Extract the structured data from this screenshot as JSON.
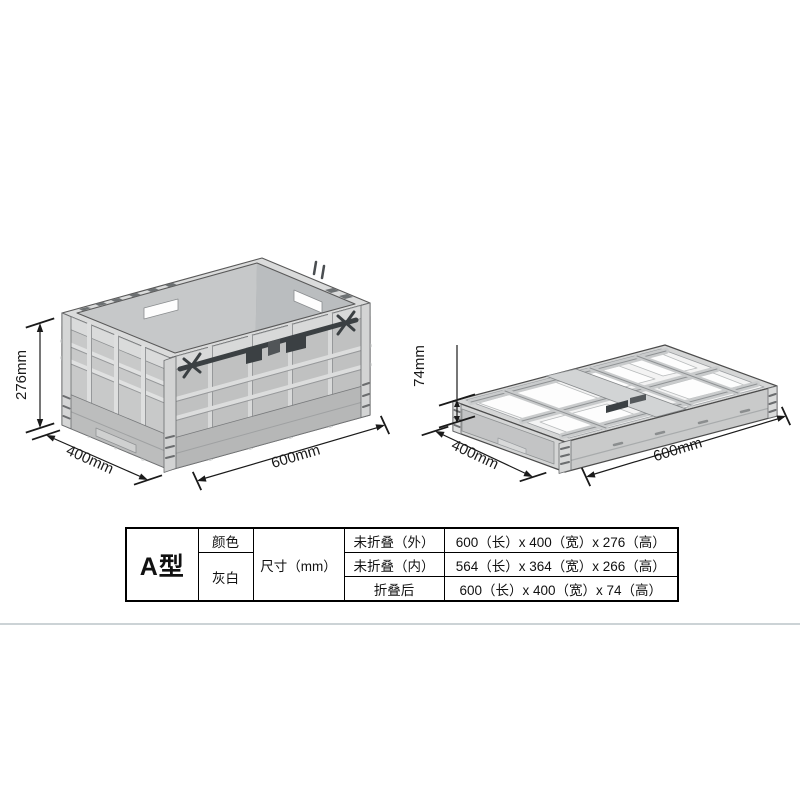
{
  "colors": {
    "background": "#ffffff",
    "crate_body": "#c8c9c9",
    "crate_light_band": "#d9dada",
    "crate_interior": "#a9acae",
    "crate_skirt": "#b9baba",
    "outline": "#4c4c4c",
    "latch_dark": "#3b4043",
    "dimension_line": "#1a1a1a",
    "table_border": "#000000",
    "divider": "#ccd3d6"
  },
  "unfolded_view": {
    "height_label": "276mm",
    "depth_label": "400mm",
    "length_label": "600mm"
  },
  "folded_view": {
    "height_label": "74mm",
    "depth_label": "400mm",
    "length_label": "600mm"
  },
  "spec_table": {
    "model": "A型",
    "color_label": "颜色",
    "color_value": "灰白",
    "size_label": "尺寸（mm）",
    "rows": [
      {
        "state": "未折叠（外）",
        "dimensions": "600（长）x 400（宽）x 276（高）"
      },
      {
        "state": "未折叠（内）",
        "dimensions": "564（长）x 364（宽）x 266（高）"
      },
      {
        "state": "折叠后",
        "dimensions": "600（长）x 400（宽）x 74（高）"
      }
    ]
  }
}
